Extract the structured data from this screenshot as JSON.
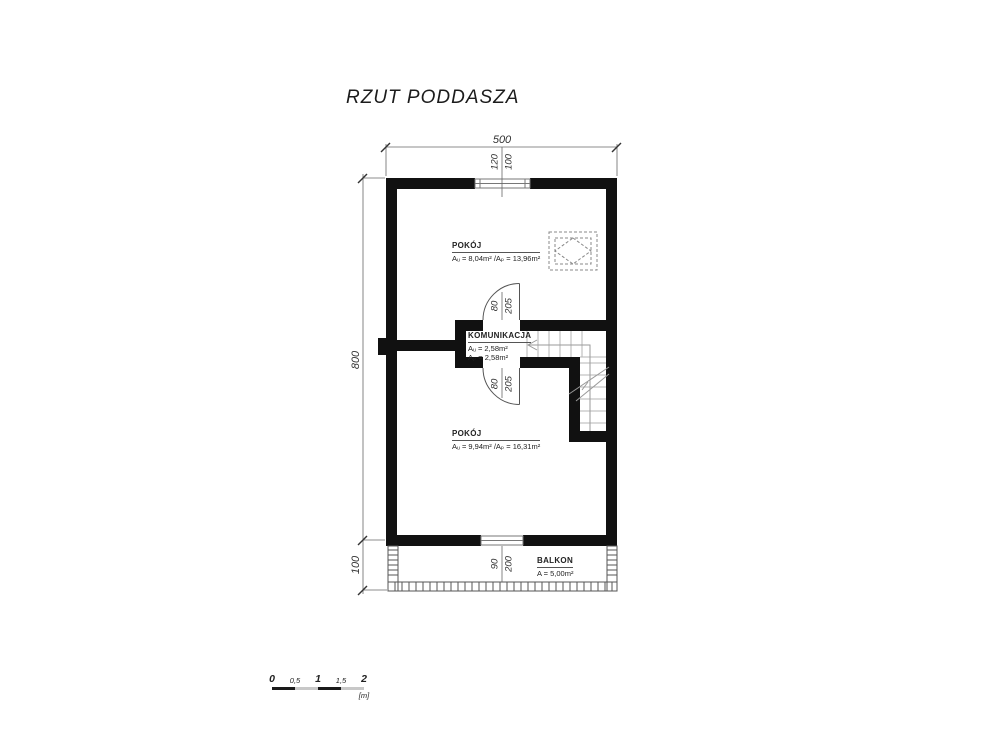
{
  "title": "RZUT PODDASZA",
  "colors": {
    "wall": "#111111",
    "thin_line": "#555555",
    "accent_gray": "#c8c8c8"
  },
  "dimensions": {
    "total_width": "500",
    "total_height": "800",
    "balcony_depth": "100",
    "top_window": {
      "width": "120",
      "offset": "100"
    },
    "upper_door": {
      "width": "80",
      "height": "205"
    },
    "lower_door": {
      "width": "80",
      "height": "205"
    },
    "balcony_door": {
      "width": "90",
      "height": "200"
    }
  },
  "rooms": {
    "pokoj_upper": {
      "name": "POKÓJ",
      "area": "Aᵤ = 8,04m² /Aₚ = 13,96m²"
    },
    "komunikacja": {
      "name": "KOMUNIKACJA",
      "area_line1": "Aᵤ = 2,58m²",
      "area_line2": "Aₚ = 2,58m²"
    },
    "pokoj_lower": {
      "name": "POKÓJ",
      "area": "Aᵤ = 9,94m² /Aₚ = 16,31m²"
    },
    "balkon": {
      "name": "BALKON",
      "area": "A = 5,00m²"
    }
  },
  "scale_bar": {
    "labels": [
      "0",
      "0,5",
      "1",
      "1,5",
      "2"
    ],
    "unit": "[m]"
  }
}
